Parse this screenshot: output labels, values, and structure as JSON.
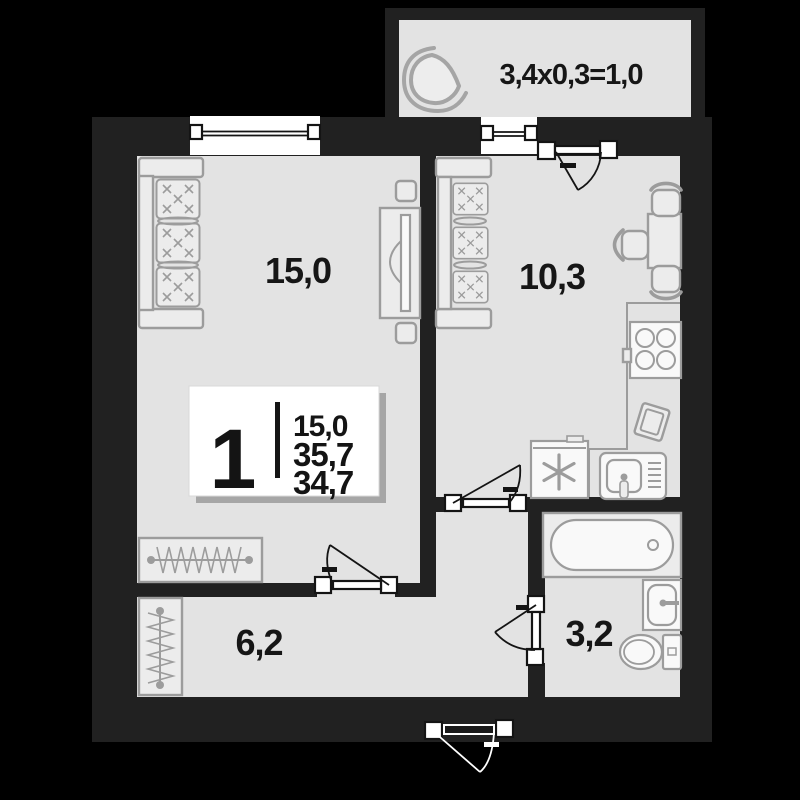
{
  "colors": {
    "background": "#000000",
    "wall": "#212121",
    "floor": "#e3e3e3",
    "furniture_stroke": "#9c9c9c",
    "text": "#161616",
    "white": "#ffffff"
  },
  "badge": {
    "room_count": "1",
    "living_area": "15,0",
    "total_area": "35,7",
    "reduced_area": "34,7"
  },
  "rooms": {
    "living": {
      "area_label": "15,0"
    },
    "kitchen": {
      "area_label": "10,3"
    },
    "hallway": {
      "area_label": "6,2"
    },
    "bathroom": {
      "area_label": "3,2"
    },
    "balcony": {
      "area_label": "3,4x0,3=1,0"
    }
  }
}
